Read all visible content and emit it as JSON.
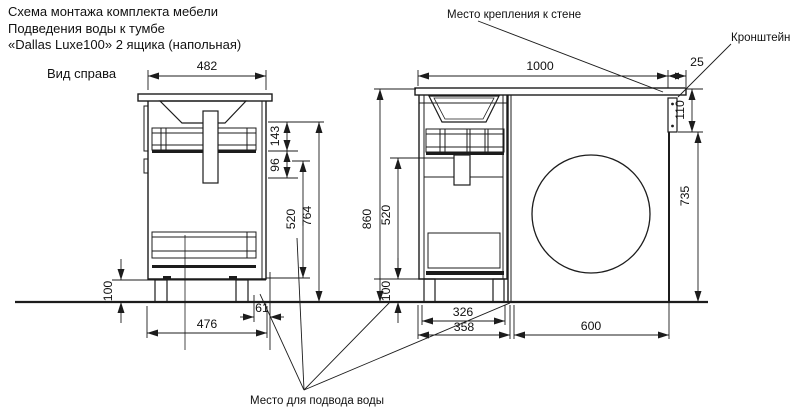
{
  "title": {
    "line1": "Схема монтажа комплекта мебели",
    "line2": "Подведения воды к тумбе",
    "line3": "«Dallas Luxe100» 2 ящика (напольная)"
  },
  "labels": {
    "view_label": "Вид справа",
    "wall_mount": "Место крепления к стене",
    "bracket": "Кронштейн",
    "water_supply": "Место для подвода воды"
  },
  "side_view": {
    "dims": {
      "top_width": "482",
      "batten_offset": "143",
      "batten_height": "96",
      "drawer_zone": "520",
      "body_height": "764",
      "leg_height": "100",
      "bottom_width": "476",
      "water_offset": "61"
    }
  },
  "front_view": {
    "dims": {
      "countertop_width": "1000",
      "overhang": "25",
      "bracket_height": "110",
      "total_height": "860",
      "drawer_zone": "520",
      "leg_height": "100",
      "niche_height": "735",
      "leg_span": "326",
      "cabinet_width": "358",
      "niche_width": "600"
    }
  },
  "colors": {
    "line": "#1c1c1c",
    "background": "#ffffff"
  }
}
